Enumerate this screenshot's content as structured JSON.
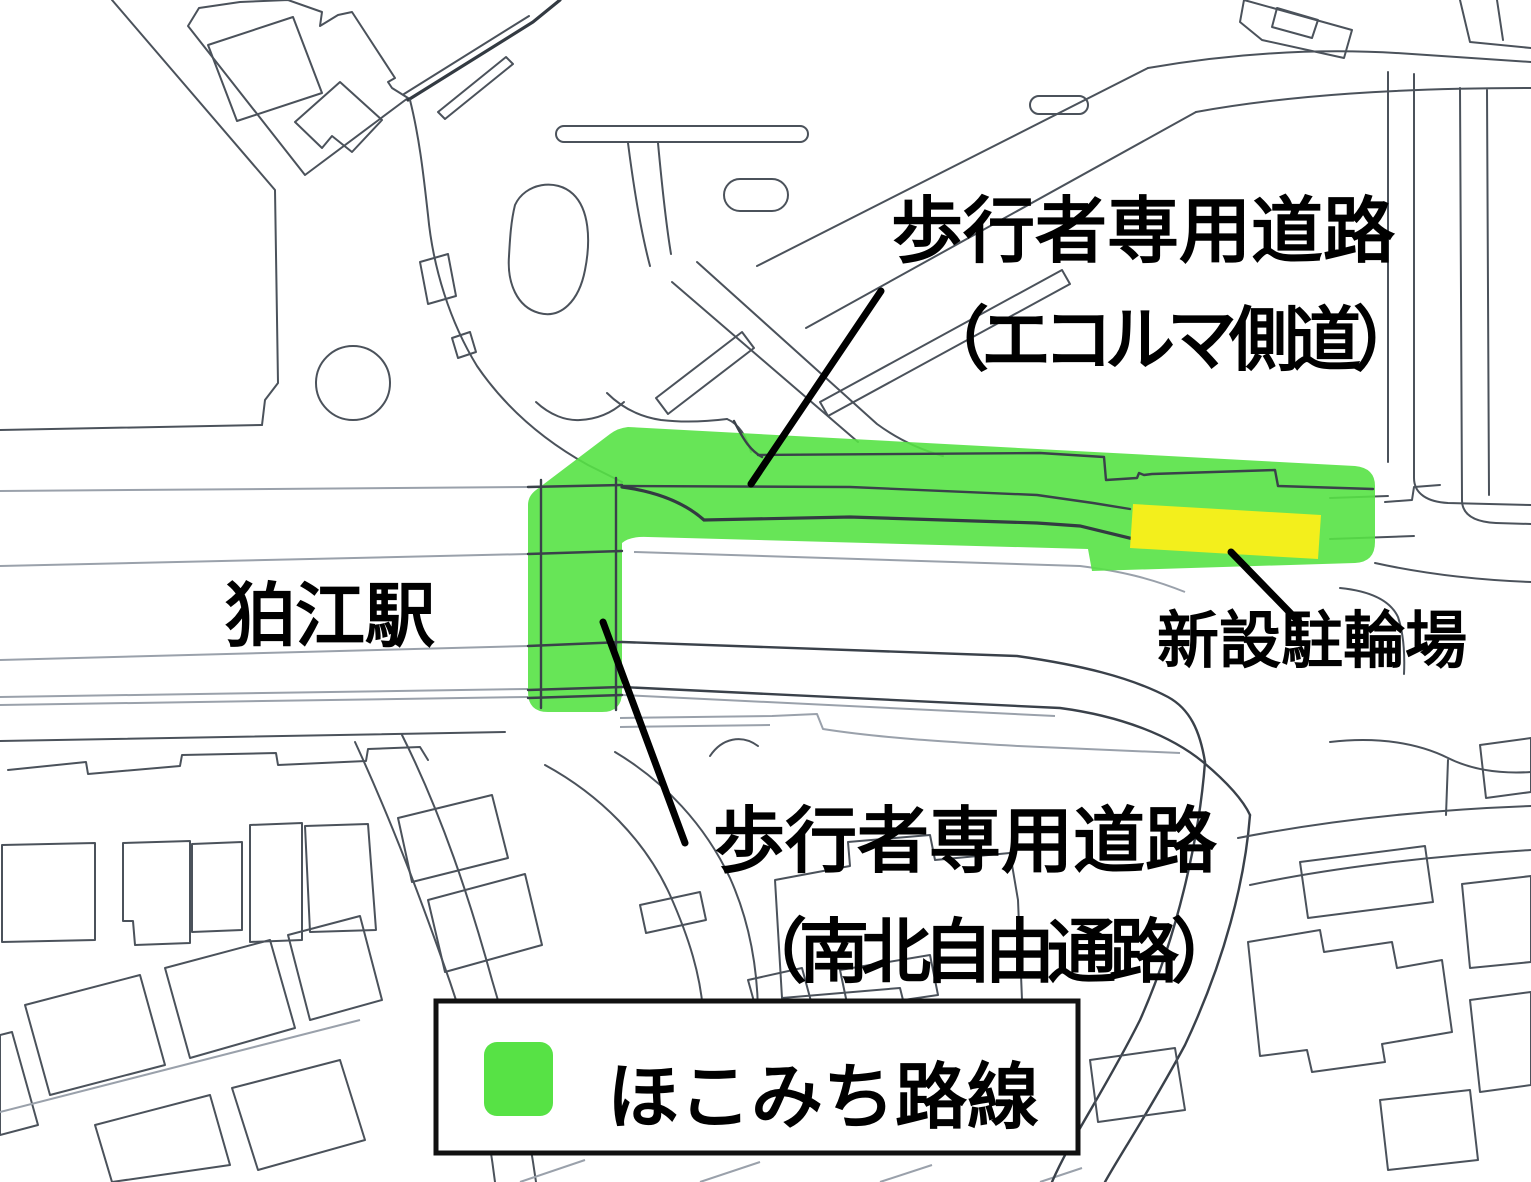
{
  "labels": {
    "ecoruma": {
      "line1": "歩行者専用道路",
      "line2": "（エコルマ側道）"
    },
    "station": "狛江駅",
    "parking": "新設駐輪場",
    "nanboku": {
      "line1": "歩行者専用道路",
      "line2": "（南北自由通路）"
    }
  },
  "legend": {
    "label": "ほこみち路線"
  },
  "colors": {
    "route_green": "#57e245",
    "parking_yellow": "#f3ef1c",
    "map_line_dark": "#4b525b",
    "map_line_light": "#9aa1ab",
    "text_black": "#000000"
  }
}
